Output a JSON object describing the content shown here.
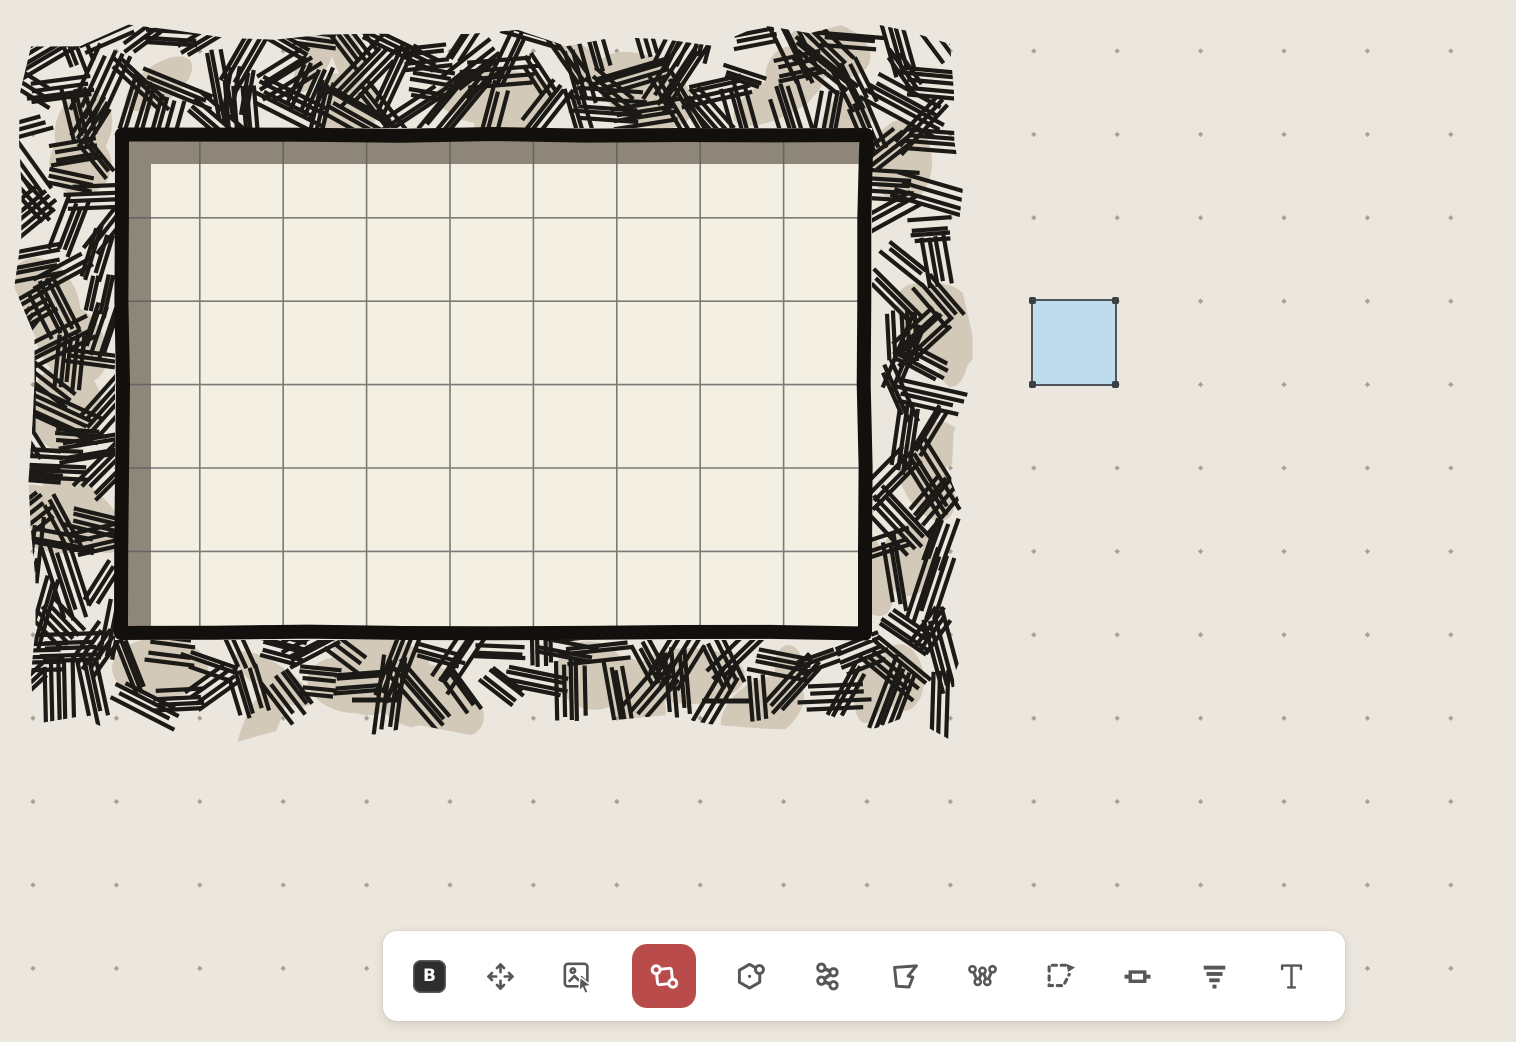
{
  "canvas": {
    "background_color": "#ece7de",
    "dot_color": "#9b9489",
    "grid_spacing": 83.4,
    "grid_origin": {
      "x": 33,
      "y": 51
    },
    "room": {
      "x": 115,
      "y": 128,
      "width": 757,
      "height": 512,
      "columns": 9,
      "rows": 6,
      "wall_color": "#12100d",
      "wall_thickness": 14,
      "floor_color": "#f3efe2",
      "shadow_color": "#8e8779",
      "grid_line_color": "#5d5d5d",
      "hatch_line_color": "#1c1a17",
      "hatch_blotch_color": "#d3c9b8"
    },
    "preview_square": {
      "x": 1031,
      "y": 299,
      "width": 86,
      "height": 87,
      "fill": "#bedcec",
      "border_color": "#4e545a",
      "handle_color": "#3a3f44"
    }
  },
  "toolbar": {
    "background_color": "#ffffff",
    "icon_color": "#575757",
    "active_color": "#b94c4b",
    "active_tool": "rectangle-draw-tool",
    "tools": [
      {
        "name": "logo-button",
        "icon": "logo-b",
        "label": "B"
      },
      {
        "name": "move-tool",
        "icon": "move-icon"
      },
      {
        "name": "image-select-tool",
        "icon": "image-cursor-icon"
      },
      {
        "name": "rectangle-draw-tool",
        "icon": "rect-corners-icon",
        "active": true
      },
      {
        "name": "polygon-draw-tool",
        "icon": "hexagon-node-icon"
      },
      {
        "name": "path-nodes-tool",
        "icon": "zigzag-nodes-icon"
      },
      {
        "name": "freeform-polygon-tool",
        "icon": "freeform-polygon-icon"
      },
      {
        "name": "wall-draw-tool",
        "icon": "wall-path-icon"
      },
      {
        "name": "select-transform-tool",
        "icon": "dashed-marquee-arrow-icon"
      },
      {
        "name": "door-tool",
        "icon": "door-icon"
      },
      {
        "name": "shadow-tool",
        "icon": "layer-bars-icon"
      },
      {
        "name": "text-tool",
        "icon": "text-icon"
      }
    ]
  }
}
